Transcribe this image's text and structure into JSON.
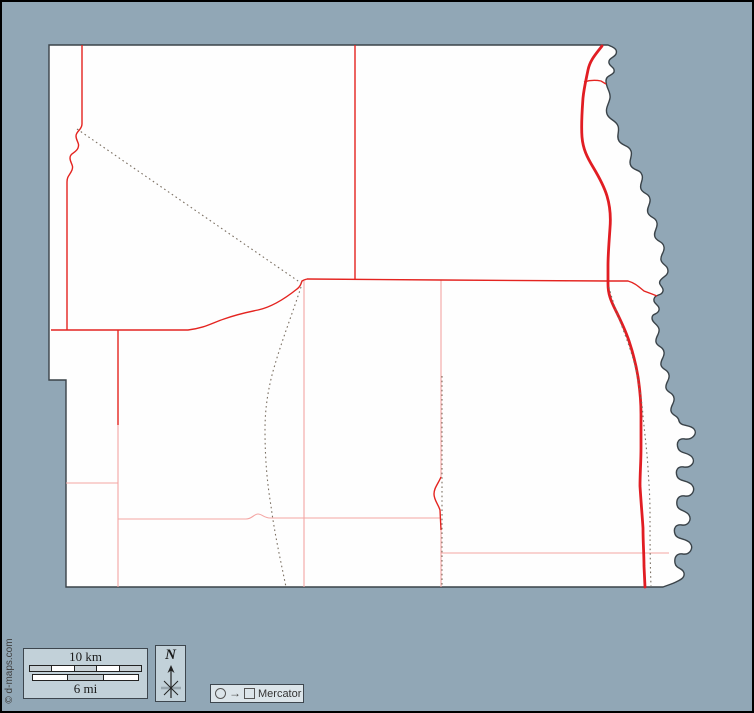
{
  "legend": {
    "scale": {
      "km_label": "10 km",
      "mi_label": "6 mi"
    },
    "north": {
      "label": "N"
    },
    "projection": {
      "label": "Mercator",
      "arrow_glyph": "→"
    }
  },
  "credit": {
    "text": "© d-maps.com"
  },
  "colors": {
    "background": "#91a7b6",
    "frame": "#000000",
    "map_fill": "#fefefe",
    "map_border": "#3a4349",
    "road_major": "#e11d23",
    "road_medium": "#e42420",
    "road_minor": "#f4a5a3",
    "boundary_dotted": "#7a6f62",
    "panel_fill": "#c2d1d9",
    "panel_border": "#3d464e",
    "mercator_panel_fill": "#dce5ea",
    "scale_bar_gray": "#c8d1d6",
    "scale_bar_white": "#ffffff",
    "text": "#1a1a1a",
    "credit_text": "#3f3f3f"
  }
}
